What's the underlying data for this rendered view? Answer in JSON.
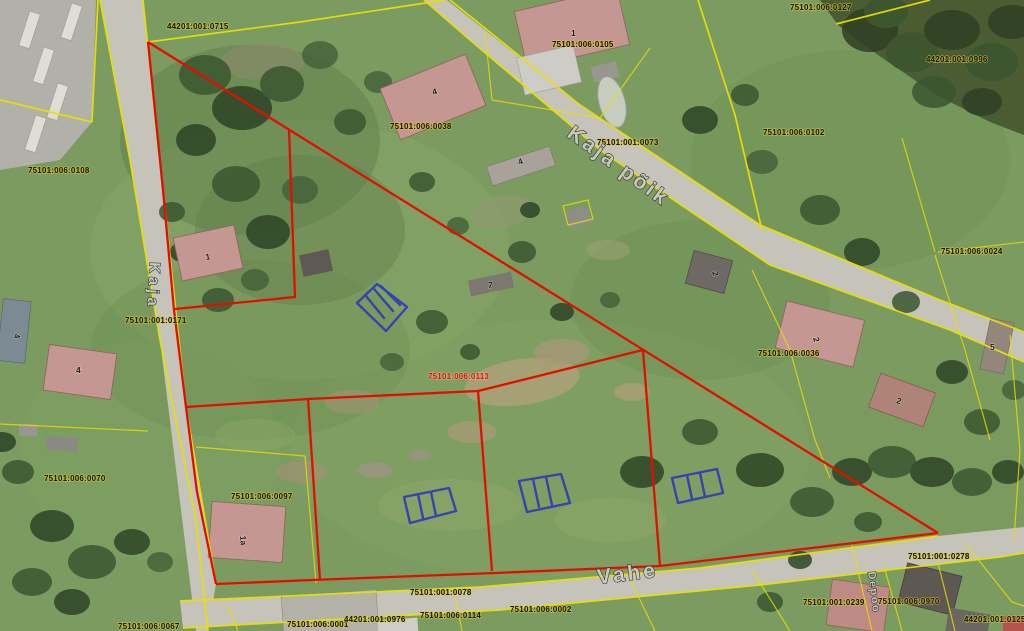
{
  "map": {
    "description": "Aerial cadastral map with parcel boundaries, selected parcel in red and sketched buildings in blue",
    "colors": {
      "cadastral_boundary": "#e8e000",
      "selected_boundary": "#e01000",
      "sketch": "#2c35b8",
      "parcel_label": "#141400",
      "selected_parcel_label": "#cf1a0c"
    },
    "street_labels": [
      {
        "name": "Kaja põik"
      },
      {
        "name": "Vahe"
      },
      {
        "name": "Kaja"
      },
      {
        "name": "Depoo"
      }
    ],
    "parcel_labels": [
      {
        "code": "44201:001:0715"
      },
      {
        "code": "75101:006:0127"
      },
      {
        "code": "75101:006:0105"
      },
      {
        "code": "44201:001:0996"
      },
      {
        "code": "75101:006:0038"
      },
      {
        "code": "75101:001:0073"
      },
      {
        "code": "75101:006:0102"
      },
      {
        "code": "75101:006:0108"
      },
      {
        "code": "75101:006:0024"
      },
      {
        "code": "75101:001:0171"
      },
      {
        "code": "75101:006:0036"
      },
      {
        "code": "75101:006:0113",
        "highlighted": true
      },
      {
        "code": "75101:006:0070"
      },
      {
        "code": "75101:006:0097"
      },
      {
        "code": "75101:001:0078"
      },
      {
        "code": "75101:001:0278"
      },
      {
        "code": "75101:006:0970"
      },
      {
        "code": "44201:001:0125"
      },
      {
        "code": "75101:006:0067"
      },
      {
        "code": "75101:006:0001"
      },
      {
        "code": "44201:001:0976"
      },
      {
        "code": "75101:006:0114"
      },
      {
        "code": "75101:006:0002"
      },
      {
        "code": "75101:001:0239"
      }
    ],
    "building_labels": [
      {
        "number": "1"
      },
      {
        "number": "4"
      },
      {
        "number": "4"
      },
      {
        "number": "1"
      },
      {
        "number": "7"
      },
      {
        "number": "2"
      },
      {
        "number": "2"
      },
      {
        "number": "5"
      },
      {
        "number": "2"
      },
      {
        "number": "4"
      },
      {
        "number": "4"
      },
      {
        "number": "1a"
      }
    ]
  }
}
